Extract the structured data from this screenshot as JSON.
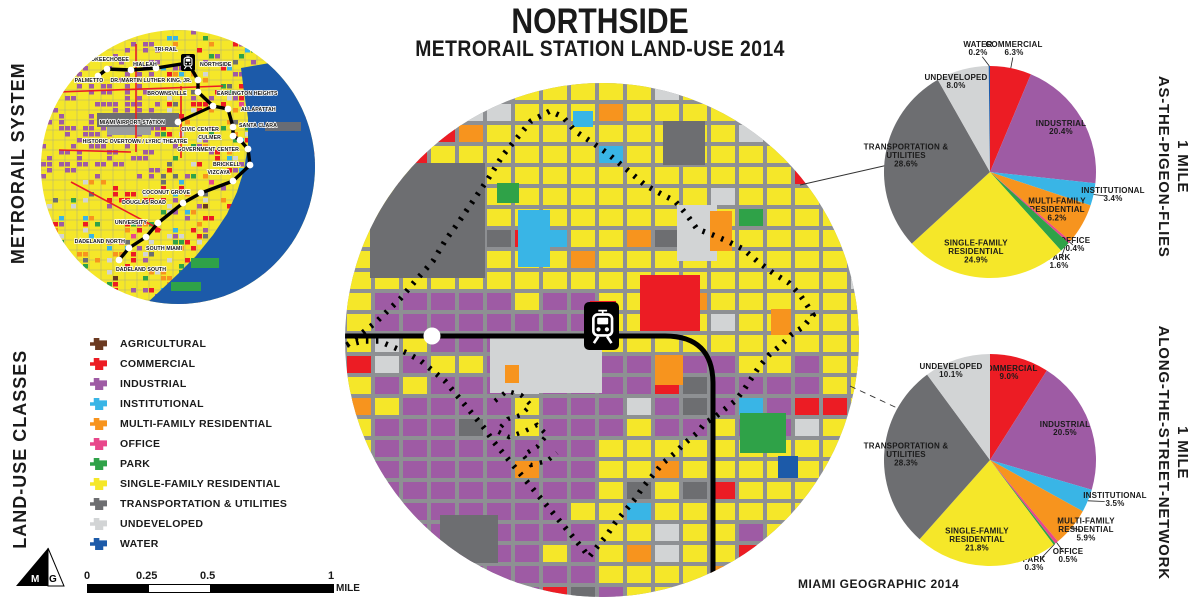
{
  "title": {
    "line1": "NORTHSIDE",
    "line2": "METRORAIL STATION LAND-USE 2014"
  },
  "credit": "MIAMI GEOGRAPHIC 2014",
  "logo_text": "MG",
  "side_labels": {
    "metrorail_system": "METRORAIL SYSTEM",
    "land_use_classes": "LAND-USE CLASSES",
    "pigeon_line1": "1 MILE",
    "pigeon_line2": "AS-THE-PIGEON-FLIES",
    "street_line1": "1 MILE",
    "street_line2": "ALONG-THE-STREET-NETWORK"
  },
  "colors": {
    "agricultural": "#6B3A21",
    "commercial": "#EC1C24",
    "industrial": "#9E5BA4",
    "institutional": "#39B5E6",
    "multi_family": "#F7941E",
    "office": "#E8478B",
    "park": "#2FA248",
    "single_family": "#F5E729",
    "transportation": "#6D6E71",
    "undeveloped": "#D2D4D5",
    "water": "#1C5AA9",
    "street": "#8E9093"
  },
  "legend": {
    "items": [
      {
        "key": "agricultural",
        "label": "AGRICULTURAL"
      },
      {
        "key": "commercial",
        "label": "COMMERCIAL"
      },
      {
        "key": "industrial",
        "label": "INDUSTRIAL"
      },
      {
        "key": "institutional",
        "label": "INSTITUTIONAL"
      },
      {
        "key": "multi_family",
        "label": "MULTI-FAMILY RESIDENTIAL"
      },
      {
        "key": "office",
        "label": "OFFICE"
      },
      {
        "key": "park",
        "label": "PARK"
      },
      {
        "key": "single_family",
        "label": "SINGLE-FAMILY RESIDENTIAL"
      },
      {
        "key": "transportation",
        "label": "TRANSPORTATION & UTILITIES"
      },
      {
        "key": "undeveloped",
        "label": "UNDEVELOPED"
      },
      {
        "key": "water",
        "label": "WATER"
      }
    ]
  },
  "scale_bar": {
    "ticks": [
      "0",
      "0.25",
      "0.5",
      "1"
    ],
    "unit": "MILE"
  },
  "metrorail_map": {
    "stations": [
      {
        "name": "PALMETTO",
        "dx": 57,
        "dy": 46,
        "lx": 48,
        "ly": 52,
        "anchor": "middle"
      },
      {
        "name": "OKEECHOBEE",
        "dx": 66,
        "dy": 39,
        "lx": 69,
        "ly": 31,
        "anchor": "middle"
      },
      {
        "name": "HIALEAH",
        "dx": 90,
        "dy": 40,
        "lx": 104,
        "ly": 36,
        "anchor": "middle"
      },
      {
        "name": "TRI-RAIL",
        "dx": 115,
        "dy": 38,
        "lx": 125,
        "ly": 21,
        "anchor": "middle"
      },
      {
        "name": "NORTHSIDE",
        "icon": true,
        "ix": 140,
        "iy": 24,
        "lx": 159,
        "ly": 36,
        "anchor": "start"
      },
      {
        "name": "DR. MARTIN LUTHER KING, JR.",
        "dx": 157,
        "dy": 50,
        "lx": 110,
        "ly": 52,
        "anchor": "middle"
      },
      {
        "name": "BROWNSVILLE",
        "dx": 157,
        "dy": 62,
        "lx": 126,
        "ly": 65,
        "anchor": "middle"
      },
      {
        "name": "EARLINGTON HEIGHTS",
        "dx": 172,
        "dy": 76,
        "lx": 176,
        "ly": 65,
        "anchor": "start"
      },
      {
        "name": "ALLAPATTAH",
        "dx": 187,
        "dy": 79,
        "lx": 200,
        "ly": 81,
        "anchor": "start"
      },
      {
        "name": "MIAMI AIRPORT STATION",
        "dx": 137,
        "dy": 92,
        "lx": 124,
        "ly": 94,
        "anchor": "end"
      },
      {
        "name": "SANTA CLARA",
        "dx": 192,
        "dy": 97,
        "lx": 198,
        "ly": 97,
        "anchor": "start"
      },
      {
        "name": "CIVIC CENTER",
        "dx": 192,
        "dy": 106,
        "lx": 178,
        "ly": 101,
        "anchor": "end"
      },
      {
        "name": "CULMER",
        "dx": 199,
        "dy": 110,
        "lx": 180,
        "ly": 109,
        "anchor": "end"
      },
      {
        "name": "GOVERNMENT CENTER",
        "dx": 207,
        "dy": 119,
        "lx": 198,
        "ly": 121,
        "anchor": "end"
      },
      {
        "name": "BRICKELL",
        "dx": 209,
        "dy": 135,
        "lx": 199,
        "ly": 136,
        "anchor": "end"
      },
      {
        "name": "VIZCAYA",
        "dx": 192,
        "dy": 151,
        "lx": 189,
        "ly": 144,
        "anchor": "end"
      },
      {
        "name": "COCONUT GROVE",
        "dx": 160,
        "dy": 163,
        "lx": 149,
        "ly": 164,
        "anchor": "end"
      },
      {
        "name": "DOUGLAS ROAD",
        "dx": 142,
        "dy": 173,
        "lx": 125,
        "ly": 174,
        "anchor": "end"
      },
      {
        "name": "UNIVERSITY",
        "dx": 117,
        "dy": 193,
        "lx": 106,
        "ly": 194,
        "anchor": "end"
      },
      {
        "name": "SOUTH MIAMI",
        "dx": 105,
        "dy": 207,
        "lx": 123,
        "ly": 220,
        "anchor": "middle"
      },
      {
        "name": "DADELAND NORTH",
        "dx": 88,
        "dy": 218,
        "lx": 84,
        "ly": 213,
        "anchor": "end"
      },
      {
        "name": "DADELAND SOUTH",
        "dx": 78,
        "dy": 230,
        "lx": 100,
        "ly": 241,
        "anchor": "middle"
      },
      {
        "name": "HISTORIC OVERTOWN / LYRIC THEATRE",
        "label_only": true,
        "lx": 94,
        "ly": 113,
        "anchor": "middle"
      }
    ]
  },
  "chart_data": [
    {
      "type": "pie",
      "title": "1 MILE AS-THE-PIGEON-FLIES",
      "legend_position": "none",
      "center": [
        990,
        172
      ],
      "radius": 106,
      "slices": [
        {
          "label_lines": [
            "COMMERCIAL"
          ],
          "pct": "6.3%",
          "value": 6.3,
          "color": "commercial",
          "mode": "out",
          "lx": 24,
          "ly": -121
        },
        {
          "label_lines": [
            "INDUSTRIAL"
          ],
          "pct": "20.4%",
          "value": 20.4,
          "color": "industrial",
          "mode": "in",
          "lx": 71,
          "ly": -42
        },
        {
          "label_lines": [
            "INSTITUTIONAL"
          ],
          "pct": "3.4%",
          "value": 3.4,
          "color": "institutional",
          "mode": "out",
          "lx": 123,
          "ly": 25
        },
        {
          "label_lines": [
            "MULTI-FAMILY",
            "RESIDENTIAL"
          ],
          "pct": "6.2%",
          "value": 6.2,
          "color": "multi_family",
          "mode": "in",
          "lx": 67,
          "ly": 40
        },
        {
          "label_lines": [
            "OFFICE"
          ],
          "pct": "0.4%",
          "value": 0.4,
          "color": "office",
          "mode": "out",
          "lx": 85,
          "ly": 75
        },
        {
          "label_lines": [
            "PARK"
          ],
          "pct": "1.6%",
          "value": 1.6,
          "color": "park",
          "mode": "out",
          "lx": 69,
          "ly": 92
        },
        {
          "label_lines": [
            "SINGLE-FAMILY",
            "RESIDENTIAL"
          ],
          "pct": "24.9%",
          "value": 24.9,
          "color": "single_family",
          "mode": "in",
          "lx": -14,
          "ly": 82
        },
        {
          "label_lines": [
            "TRANSPORTATION &",
            "UTILITIES"
          ],
          "pct": "28.6%",
          "value": 28.6,
          "color": "transportation",
          "mode": "in",
          "lx": -84,
          "ly": -14
        },
        {
          "label_lines": [
            "UNDEVELOPED"
          ],
          "pct": "8.0%",
          "value": 8.0,
          "color": "undeveloped",
          "mode": "in",
          "lx": -34,
          "ly": -88
        },
        {
          "label_lines": [
            "WATER"
          ],
          "pct": "0.2%",
          "value": 0.2,
          "color": "water",
          "mode": "out",
          "lx": -12,
          "ly": -121
        }
      ]
    },
    {
      "type": "pie",
      "title": "1 MILE ALONG-THE-STREET-NETWORK",
      "legend_position": "none",
      "center": [
        990,
        460
      ],
      "radius": 106,
      "slices": [
        {
          "label_lines": [
            "COMMERCIAL"
          ],
          "pct": "9.0%",
          "value": 9.0,
          "color": "commercial",
          "mode": "in",
          "lx": 19,
          "ly": -85
        },
        {
          "label_lines": [
            "INDUSTRIAL"
          ],
          "pct": "20.5%",
          "value": 20.5,
          "color": "industrial",
          "mode": "in",
          "lx": 75,
          "ly": -29
        },
        {
          "label_lines": [
            "INSTITUTIONAL"
          ],
          "pct": "3.5%",
          "value": 3.5,
          "color": "institutional",
          "mode": "out",
          "lx": 125,
          "ly": 42
        },
        {
          "label_lines": [
            "MULTI-FAMILY",
            "RESIDENTIAL"
          ],
          "pct": "5.9%",
          "value": 5.9,
          "color": "multi_family",
          "mode": "out",
          "lx": 96,
          "ly": 72
        },
        {
          "label_lines": [
            "OFFICE"
          ],
          "pct": "0.5%",
          "value": 0.5,
          "color": "office",
          "mode": "out",
          "lx": 78,
          "ly": 98
        },
        {
          "label_lines": [
            "PARK"
          ],
          "pct": "0.3%",
          "value": 0.3,
          "color": "park",
          "mode": "out",
          "lx": 44,
          "ly": 106
        },
        {
          "label_lines": [
            "SINGLE-FAMILY",
            "RESIDENTIAL"
          ],
          "pct": "21.8%",
          "value": 21.8,
          "color": "single_family",
          "mode": "in",
          "lx": -13,
          "ly": 82
        },
        {
          "label_lines": [
            "TRANSPORTATION &",
            "UTILITIES"
          ],
          "pct": "28.3%",
          "value": 28.3,
          "color": "transportation",
          "mode": "in",
          "lx": -84,
          "ly": -3
        },
        {
          "label_lines": [
            "UNDEVELOPED"
          ],
          "pct": "10.1%",
          "value": 10.1,
          "color": "undeveloped",
          "mode": "in",
          "lx": -39,
          "ly": -87
        }
      ]
    }
  ]
}
